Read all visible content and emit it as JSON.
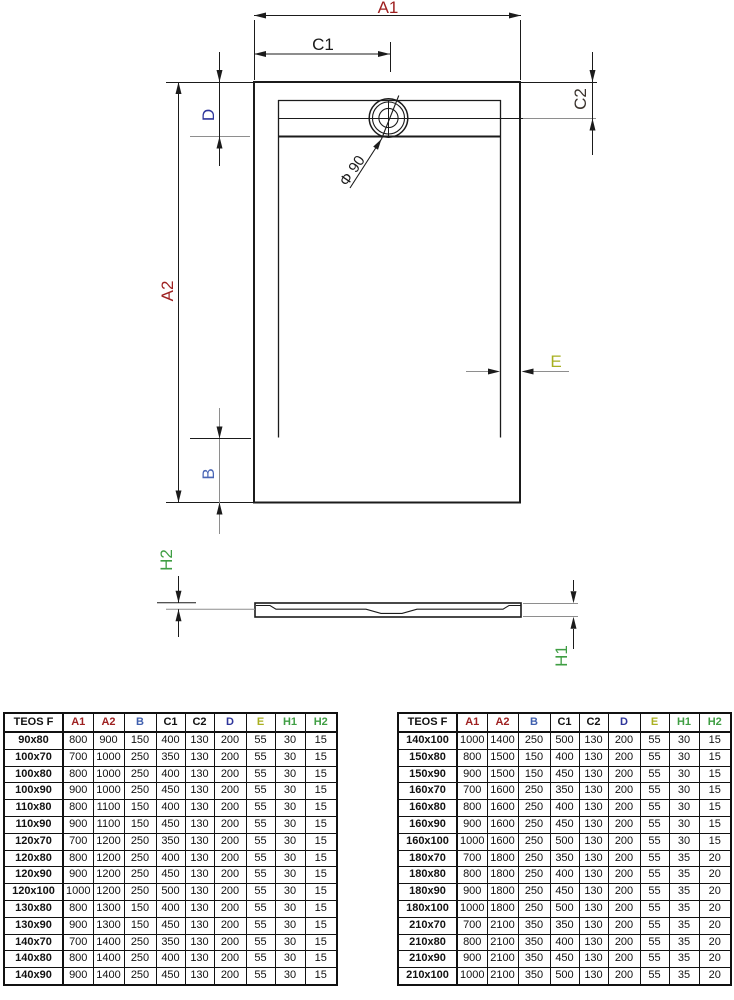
{
  "drawing": {
    "labels": {
      "a1": "A1",
      "a2": "A2",
      "b": "B",
      "c1": "C1",
      "c2": "C2",
      "d": "D",
      "e": "E",
      "h1": "H1",
      "h2": "H2",
      "drain": "Φ 90"
    },
    "label_colors": {
      "a1": "#9e2020",
      "a2": "#9e2020",
      "b": "#4a66b5",
      "c1": "#1a1a1a",
      "c2": "#3a322c",
      "d": "#2e359b",
      "e": "#a8b021",
      "h1": "#3f9e43",
      "h2": "#3f9e43",
      "drain": "#1a1a1a"
    },
    "line_color": "#1b1b1b",
    "aux_line_color": "#8e8e8e"
  },
  "tables": {
    "columns": [
      "TEOS F",
      "A1",
      "A2",
      "B",
      "C1",
      "C2",
      "D",
      "E",
      "H1",
      "H2"
    ],
    "column_colors": [
      "#111111",
      "#9e2020",
      "#9e2020",
      "#3f5fae",
      "#111111",
      "#111111",
      "#2e359b",
      "#aab021",
      "#3f9e43",
      "#3f9e43"
    ],
    "left": {
      "rows": [
        [
          "90x80",
          800,
          900,
          150,
          400,
          130,
          200,
          55,
          30,
          15
        ],
        [
          "100x70",
          700,
          1000,
          250,
          350,
          130,
          200,
          55,
          30,
          15
        ],
        [
          "100x80",
          800,
          1000,
          250,
          400,
          130,
          200,
          55,
          30,
          15
        ],
        [
          "100x90",
          900,
          1000,
          250,
          450,
          130,
          200,
          55,
          30,
          15
        ],
        [
          "110x80",
          800,
          1100,
          150,
          400,
          130,
          200,
          55,
          30,
          15
        ],
        [
          "110x90",
          900,
          1100,
          150,
          450,
          130,
          200,
          55,
          30,
          15
        ],
        [
          "120x70",
          700,
          1200,
          250,
          350,
          130,
          200,
          55,
          30,
          15
        ],
        [
          "120x80",
          800,
          1200,
          250,
          400,
          130,
          200,
          55,
          30,
          15
        ],
        [
          "120x90",
          900,
          1200,
          250,
          450,
          130,
          200,
          55,
          30,
          15
        ],
        [
          "120x100",
          1000,
          1200,
          250,
          500,
          130,
          200,
          55,
          30,
          15
        ],
        [
          "130x80",
          800,
          1300,
          150,
          400,
          130,
          200,
          55,
          30,
          15
        ],
        [
          "130x90",
          900,
          1300,
          150,
          450,
          130,
          200,
          55,
          30,
          15
        ],
        [
          "140x70",
          700,
          1400,
          250,
          350,
          130,
          200,
          55,
          30,
          15
        ],
        [
          "140x80",
          800,
          1400,
          250,
          400,
          130,
          200,
          55,
          30,
          15
        ],
        [
          "140x90",
          900,
          1400,
          250,
          450,
          130,
          200,
          55,
          30,
          15
        ]
      ]
    },
    "right": {
      "rows": [
        [
          "140x100",
          1000,
          1400,
          250,
          500,
          130,
          200,
          55,
          30,
          15
        ],
        [
          "150x80",
          800,
          1500,
          150,
          400,
          130,
          200,
          55,
          30,
          15
        ],
        [
          "150x90",
          900,
          1500,
          150,
          450,
          130,
          200,
          55,
          30,
          15
        ],
        [
          "160x70",
          700,
          1600,
          250,
          350,
          130,
          200,
          55,
          30,
          15
        ],
        [
          "160x80",
          800,
          1600,
          250,
          400,
          130,
          200,
          55,
          30,
          15
        ],
        [
          "160x90",
          900,
          1600,
          250,
          450,
          130,
          200,
          55,
          30,
          15
        ],
        [
          "160x100",
          1000,
          1600,
          250,
          500,
          130,
          200,
          55,
          30,
          15
        ],
        [
          "180x70",
          700,
          1800,
          250,
          350,
          130,
          200,
          55,
          35,
          20
        ],
        [
          "180x80",
          800,
          1800,
          250,
          400,
          130,
          200,
          55,
          35,
          20
        ],
        [
          "180x90",
          900,
          1800,
          250,
          450,
          130,
          200,
          55,
          35,
          20
        ],
        [
          "180x100",
          1000,
          1800,
          250,
          500,
          130,
          200,
          55,
          35,
          20
        ],
        [
          "210x70",
          700,
          2100,
          350,
          350,
          130,
          200,
          55,
          35,
          20
        ],
        [
          "210x80",
          800,
          2100,
          350,
          400,
          130,
          200,
          55,
          35,
          20
        ],
        [
          "210x90",
          900,
          2100,
          350,
          450,
          130,
          200,
          55,
          35,
          20
        ],
        [
          "210x100",
          1000,
          2100,
          350,
          500,
          130,
          200,
          55,
          35,
          20
        ]
      ]
    }
  }
}
